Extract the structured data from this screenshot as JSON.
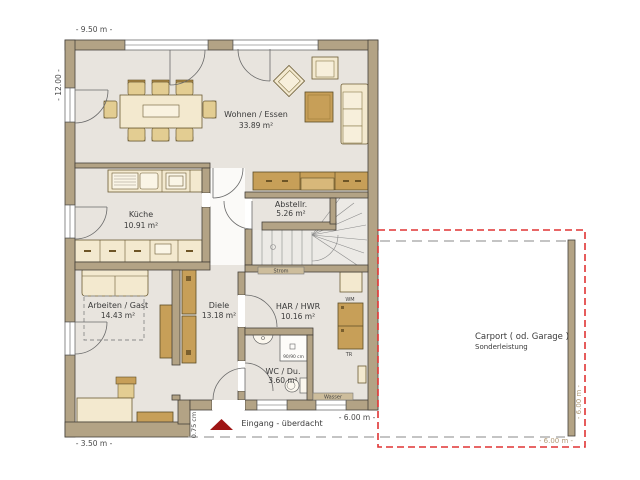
{
  "plan": {
    "rooms": [
      {
        "name": "Wohnen / Essen",
        "area": "33.89 m²"
      },
      {
        "name": "Küche",
        "area": "10.91 m²"
      },
      {
        "name": "Abstellr.",
        "area": "5.26 m²"
      },
      {
        "name": "Arbeiten / Gast",
        "area": "14.43 m²"
      },
      {
        "name": "Diele",
        "area": "13.18 m²"
      },
      {
        "name": "HAR / HWR",
        "area": "10.16 m²"
      },
      {
        "name": "WC / Du.",
        "area": "3.60 m²"
      }
    ],
    "labels": {
      "entrance": "Eingang - überdacht",
      "carport_title": "Carport ( od. Garage )",
      "carport_subtitle": "Sonderleistung"
    },
    "dimensions": {
      "top": "- 9.50 m -",
      "left": "- 12.00 -",
      "bottom_left": "- 3.50 m -",
      "entrance_width": "- 6.00 m -",
      "entrance_depth": "0.75 cm",
      "carport_width": "- 6.00 m -",
      "carport_depth": "- 6.00 m -"
    },
    "annotations": {
      "strom": "Strom",
      "wasser": "Wasser",
      "washer": "WM",
      "dryer": "TR",
      "shower_size": "90/90 cm"
    },
    "colors": {
      "wall": "#b3a385",
      "floor": "#e8e4de",
      "furniture_light": "#f3e9cf",
      "furniture_wood": "#c79f58",
      "carport_outline": "#e03434",
      "entrance_arrow": "#9e1515"
    }
  }
}
